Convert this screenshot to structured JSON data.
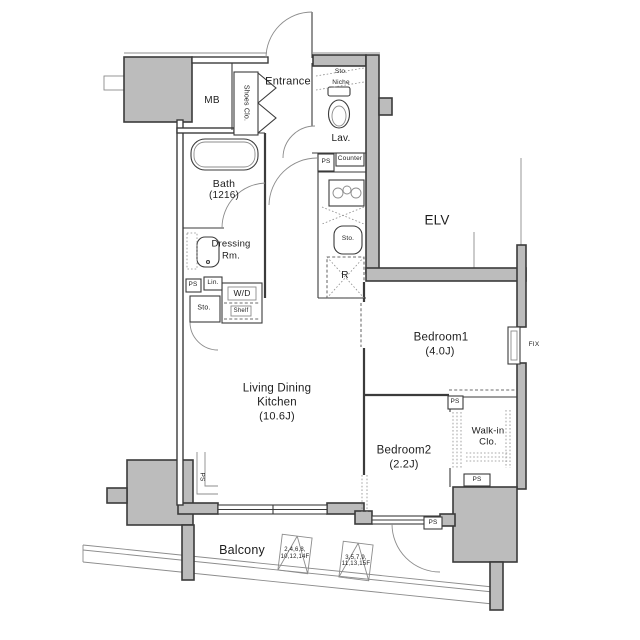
{
  "labels": {
    "entrance": "Entrance",
    "shoes_closet": "Shoes Clo.",
    "meter_box": "MB",
    "storage": "Sto.",
    "niche": "Niche",
    "lavatory": "Lav.",
    "pipe_space": "PS",
    "counter": "Counter",
    "bath_name": "Bath",
    "bath_size": "(1216)",
    "dressing_line1": "Dressing",
    "dressing_line2": "Rm.",
    "linen": "Lin.",
    "washer_dryer": "W/D",
    "shelf": "Shelf",
    "refrigerator": "R",
    "elevator": "ELV",
    "ldk_line1": "Living Dining",
    "ldk_line2": "Kitchen",
    "ldk_size": "(10.6J)",
    "bedroom1_name": "Bedroom1",
    "bedroom1_size": "(4.0J)",
    "bedroom2_name": "Bedroom2",
    "bedroom2_size": "(2.2J)",
    "walkin_line1": "Walk-in",
    "walkin_line2": "Clo.",
    "fixed_window": "FIX",
    "balcony": "Balcony",
    "hatch_even_line1": "2,4,6,8,",
    "hatch_even_line2": "10,12,14F",
    "hatch_odd_line1": "3,5,7,9,",
    "hatch_odd_line2": "11,13,15F"
  },
  "colors": {
    "background": "#ffffff",
    "concrete_fill": "#bcbcbc",
    "wall_line": "#3b3b3b",
    "thin_line": "#8c8c8c",
    "text": "#1d1d1d"
  }
}
